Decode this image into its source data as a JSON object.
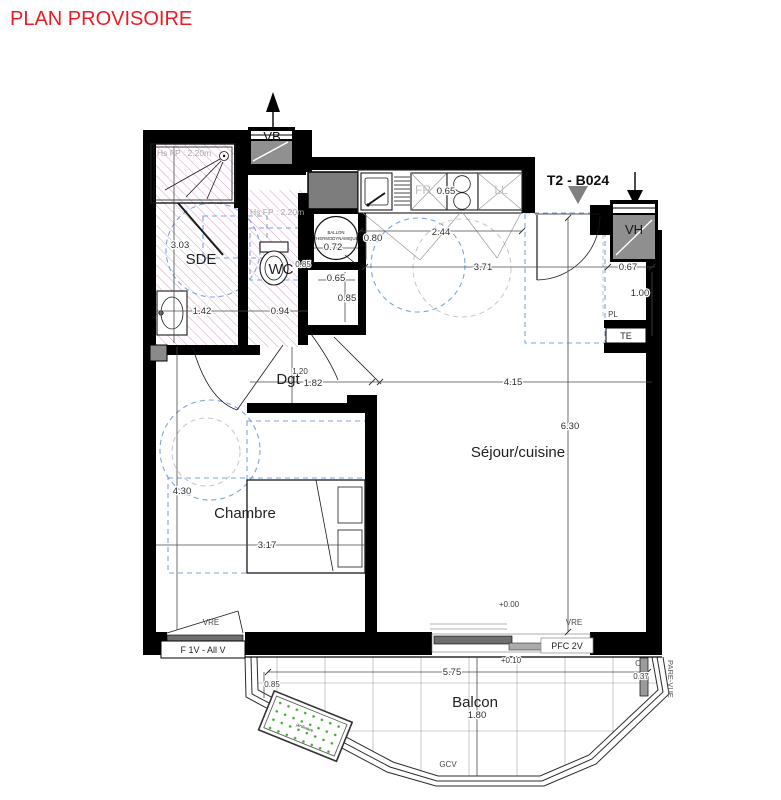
{
  "header": {
    "title": "PLAN PROVISOIRE"
  },
  "plan": {
    "unit": "T2 - B024",
    "rooms": {
      "sde": "SDE",
      "wc": "WC",
      "dgt": "Dgt",
      "chambre": "Chambre",
      "sejour": "Séjour/cuisine",
      "balcon": "Balcon"
    },
    "levels": {
      "interior": "+0.00",
      "balcony": "+0.10"
    },
    "ceiling_heights": {
      "sde": "Hs FP : 2.20m",
      "wc": "Hs FP : 2.20m"
    },
    "equipment": {
      "vb": "VB",
      "vh": "VH",
      "pl": "PL",
      "te": "TE",
      "fridge": "FR",
      "washer": "LL",
      "ballon_line1": "BALLON",
      "ballon_line2": "THERMODYNAMIQUE",
      "jardiniere": "jardinière",
      "gcv": "GCV",
      "pare_vue": "PARE-VUE",
      "corner_mark": "C"
    },
    "windows": {
      "vre_chambre": "VRE",
      "vre_sejour": "VRE",
      "chambre_window": "F 1V - All V",
      "sejour_window": "PFC 2V"
    },
    "dimensions": {
      "sde_height": "3.03",
      "sde_width": "1.42",
      "wc_width": "0.94",
      "wc_depth": "0.85",
      "kitchen_width": "2.44",
      "hob_width": "0.65",
      "sejour_top": "3.71",
      "entry_side": "0.67",
      "pl_depth": "1.00",
      "ballon_depth": "0.80",
      "ballon_width": "0.72",
      "nook_width": "0.65",
      "nook_depth": "0.85",
      "dgt_width": "1.20",
      "dgt_opening": "1.82",
      "sejour_width": "4.15",
      "sejour_height": "6.30",
      "chambre_height": "4.30",
      "chambre_width": "3.17",
      "balcon_width": "5.75",
      "balcon_depth": "1.80",
      "balcon_edge": "0.85",
      "pare_vue_width": "0.37"
    }
  },
  "colors": {
    "title_red": "#ed1c24",
    "wall_black": "#000000",
    "hatch_pink": "#d98fc6",
    "accessibility_blue": "#7aa5dc",
    "furniture_gray": "#c6c6c6",
    "equipment_gray": "#7d7d7d",
    "planter_green": "#44aa33"
  }
}
